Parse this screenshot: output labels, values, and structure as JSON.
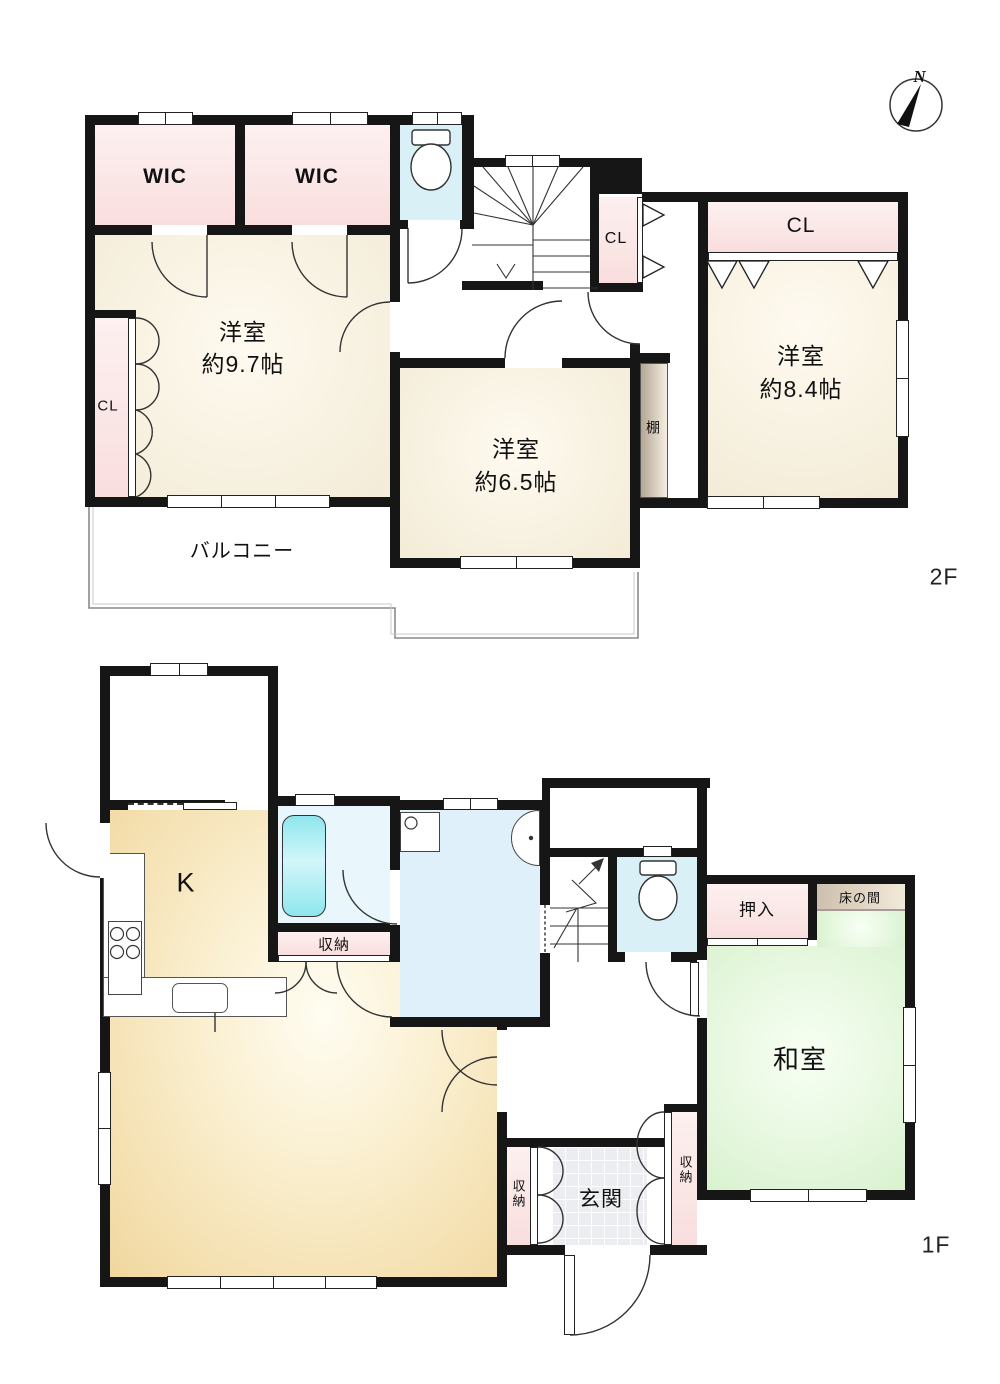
{
  "compass": {
    "north": "N"
  },
  "floor2": {
    "label": "2F",
    "wic1": "WIC",
    "wic2": "WIC",
    "closet_left": "CL",
    "closet_stairs": "CL",
    "closet_main": "CL",
    "room_97": {
      "name": "洋室",
      "size": "約9.7帖"
    },
    "room_65": {
      "name": "洋室",
      "size": "約6.5帖"
    },
    "room_84": {
      "name": "洋室",
      "size": "約8.4帖"
    },
    "shelf": "棚",
    "balcony": "バルコニー"
  },
  "floor1": {
    "label": "1F",
    "kitchen": "K",
    "storage_bath": "収納",
    "storage_entry_left": "収納",
    "storage_entry_right": "収納",
    "oshiire": "押入",
    "tokonoma": "床の間",
    "washitsu": "和室",
    "genkan": "玄関"
  },
  "colors": {
    "wall": "#161616",
    "closet_pink": "#f9dede",
    "room_cream": "#f3ecd8",
    "toilet_cyan": "#d9f1f6",
    "bath_blue": "#e9f6fb",
    "washroom_blue": "#e0f0fa",
    "bathtub_cyan": "#8fe6ee",
    "ldk_tan": "#f1d79e",
    "tatami_green": "#d9f2cf",
    "genkan_tile": "#ebedf0"
  }
}
